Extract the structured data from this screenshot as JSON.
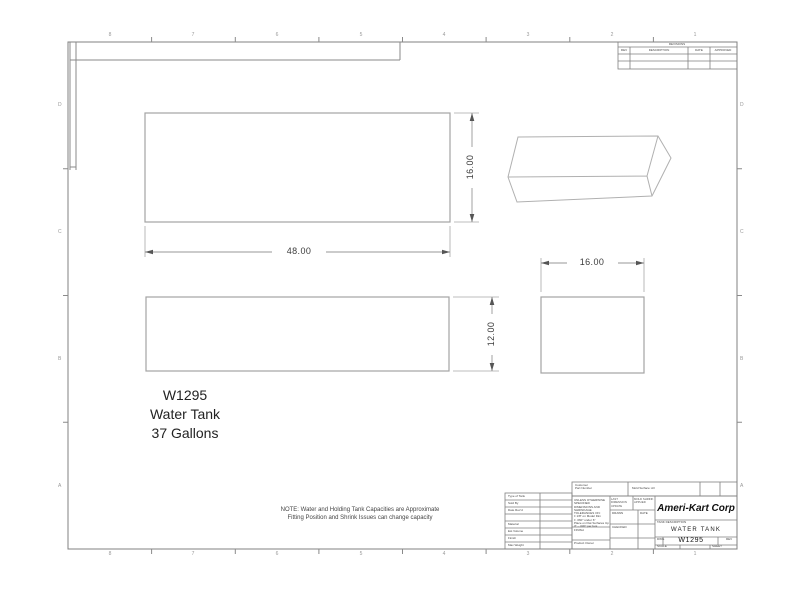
{
  "drawing": {
    "part_number": "W1295",
    "part_name": "Water Tank",
    "capacity": "37 Gallons",
    "note_line1": "NOTE: Water and Holding Tank Capacities are Approximate",
    "note_line2": "Fitting Position and Shrink Issues can change capacity"
  },
  "dimensions": {
    "top_view_width": "48.00",
    "top_view_depth": "16.00",
    "side_view_height": "12.00",
    "end_view_width": "16.00"
  },
  "zones": {
    "columns": [
      "8",
      "7",
      "6",
      "5",
      "4",
      "3",
      "2",
      "1"
    ],
    "rows": [
      "D",
      "C",
      "B",
      "A"
    ]
  },
  "revision_table": {
    "title": "REVISIONS",
    "col_rev": "REV",
    "col_description": "DESCRIPTION",
    "col_date": "DATE",
    "col_approved": "APPROVED"
  },
  "title_block": {
    "company": "Ameri-Kart Corp",
    "title_label": "TANK DESCRIPTION",
    "title": "WATER TANK",
    "size_label": "DWG",
    "dwg_no": "W1295",
    "rev_label": "REV",
    "scale_label": "SCALE",
    "sheet_label": "SHEET",
    "customer_label": "Customer",
    "part_number_label": "Part Number",
    "mold_label": "Mold Surface: All",
    "fields": [
      {
        "label": "Type of Tank"
      },
      {
        "label": "Sold By"
      },
      {
        "label": "Date Rec'd"
      },
      {
        "label": ""
      },
      {
        "label": "Material"
      },
      {
        "label": "Est Volume"
      },
      {
        "label": "Finish"
      },
      {
        "label": "Max Weight"
      }
    ],
    "tolerance_notes": [
      "UNLESS OTHERWISE SPECIFIED",
      "DIMENSIONS AND SHRINKAGE",
      "TOLERANCES ON:",
      "± 1/8\" on Model Dim",
      "± .060\" under 6\"",
      "Place on Flat Surfaces Up",
      "3\" - .030\" per foot"
    ],
    "finish_label": "FINISH",
    "product_owner_label": "Product Owner",
    "sign_header_1": "LAST DIMENSION UPDATE",
    "sign_header_2": "MOLD SHRINK APPLIED",
    "drawn_label": "DRAWN",
    "checked_label": "CHECKED",
    "date_label": "DATE"
  }
}
